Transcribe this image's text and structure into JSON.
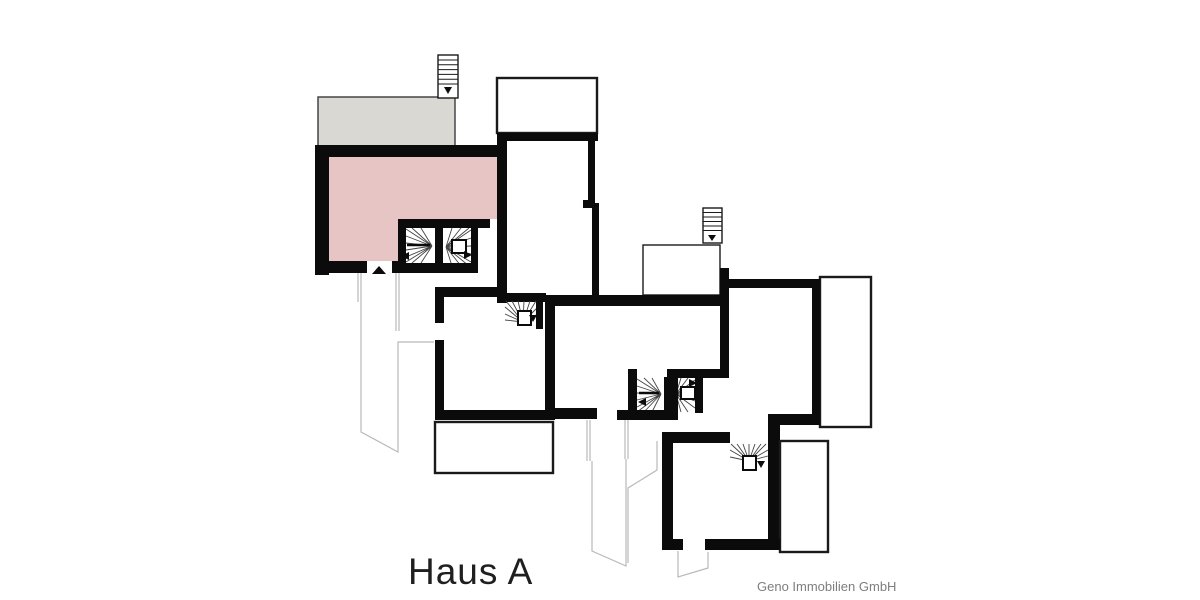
{
  "title": {
    "label": "Haus A"
  },
  "watermark": {
    "label": "Geno Immobilien GmbH"
  },
  "colors": {
    "background": "#ffffff",
    "wall": "#0b0b0b",
    "highlight_room": "#e7c5c4",
    "terrace": "#d9d8d3",
    "thin_outline": "#1a1a1a",
    "site_path": "#b9b9b9",
    "stair_tread": "#444444",
    "title_text": "#1f1f1f",
    "watermark_text": "#7e7e7e"
  }
}
